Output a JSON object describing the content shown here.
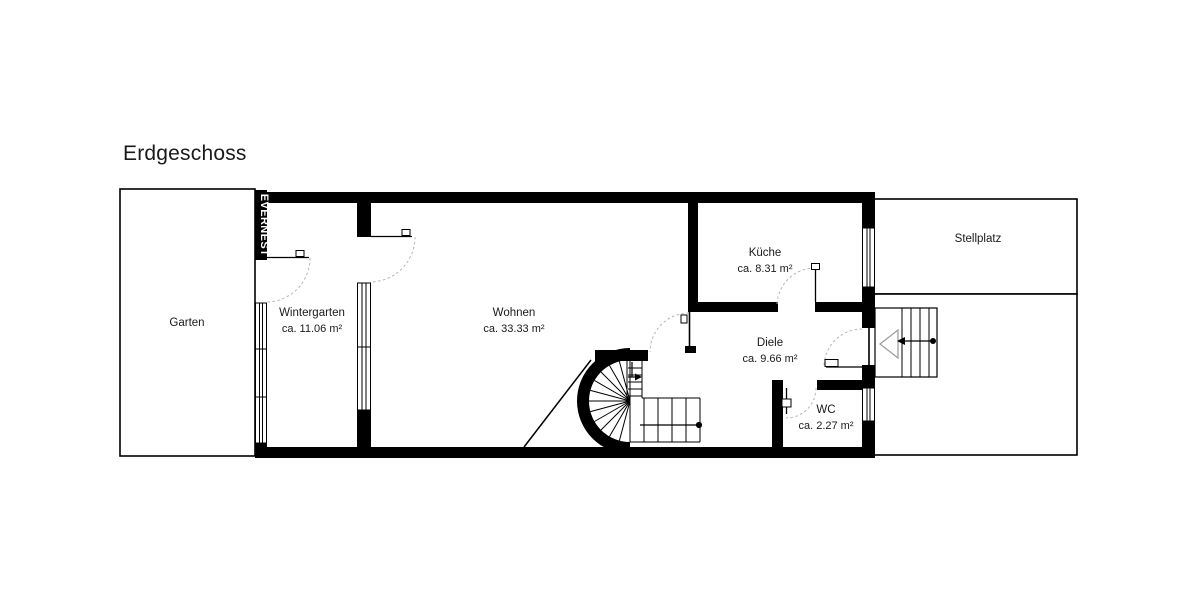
{
  "title": "Erdgeschoss",
  "watermark": "EVERNEST",
  "rooms": [
    {
      "name": "Garten",
      "area": ""
    },
    {
      "name": "Wintergarten",
      "area": "ca. 11.06 m²"
    },
    {
      "name": "Wohnen",
      "area": "ca. 33.33 m²"
    },
    {
      "name": "Küche",
      "area": "ca. 8.31 m²"
    },
    {
      "name": "Diele",
      "area": "ca. 9.66 m²"
    },
    {
      "name": "WC",
      "area": "ca. 2.27 m²"
    },
    {
      "name": "Stellplatz",
      "area": ""
    }
  ],
  "colors": {
    "background": "#ffffff",
    "wall": "#000000",
    "text": "#1a1a1a",
    "door_arc": "#b5b5b5",
    "watermark_background": "#000000",
    "watermark_text": "#ffffff"
  }
}
